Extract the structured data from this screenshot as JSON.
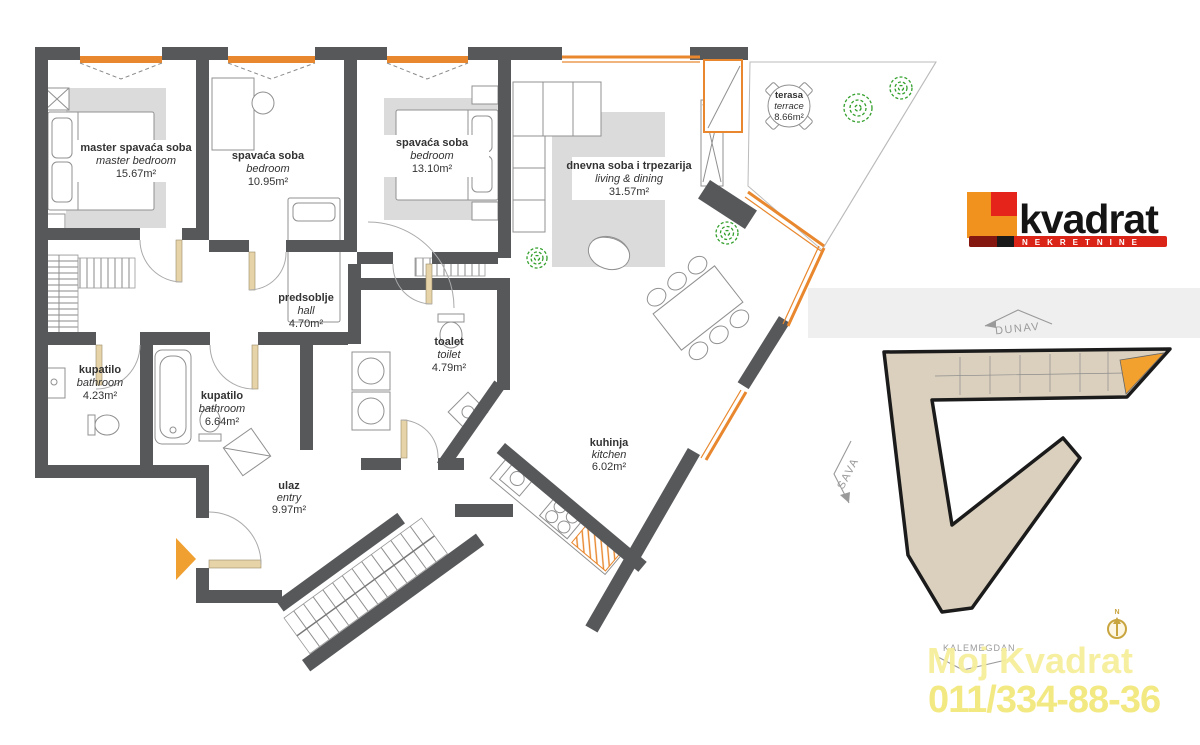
{
  "title": "Apartment floor plan",
  "floorplan": {
    "rooms": [
      {
        "id": "master-bedroom",
        "name_sr": "master spavaća soba",
        "name_en": "master bedroom",
        "area": "15.67m²"
      },
      {
        "id": "bedroom-2",
        "name_sr": "spavaća soba",
        "name_en": "bedroom",
        "area": "10.95m²"
      },
      {
        "id": "bedroom-3",
        "name_sr": "spavaća soba",
        "name_en": "bedroom",
        "area": "13.10m²"
      },
      {
        "id": "living-dining",
        "name_sr": "dnevna soba i trpezarija",
        "name_en": "living & dining",
        "area": "31.57m²"
      },
      {
        "id": "terrace",
        "name_sr": "terasa",
        "name_en": "terrace",
        "area": "8.66m²"
      },
      {
        "id": "hall",
        "name_sr": "predsoblje",
        "name_en": "hall",
        "area": "4.70m²"
      },
      {
        "id": "toilet",
        "name_sr": "toalet",
        "name_en": "toilet",
        "area": "4.79m²"
      },
      {
        "id": "bathroom-1",
        "name_sr": "kupatilo",
        "name_en": "bathroom",
        "area": "4.23m²"
      },
      {
        "id": "bathroom-2",
        "name_sr": "kupatilo",
        "name_en": "bathroom",
        "area": "6.64m²"
      },
      {
        "id": "entry",
        "name_sr": "ulaz",
        "name_en": "entry",
        "area": "9.97m²"
      },
      {
        "id": "kitchen",
        "name_sr": "kuhinja",
        "name_en": "kitchen",
        "area": "6.02m²"
      }
    ]
  },
  "siteplan": {
    "river_top": "DUNAV",
    "river_left": "SAVA",
    "landmark": "KALEMEGDAN",
    "north": "N"
  },
  "logo": {
    "name": "kvadrat",
    "tagline": "NEKRETNINE"
  },
  "watermark": {
    "line1": "Moj Kvadrat",
    "line2": "011/334-88-36"
  },
  "colors": {
    "wall": "#57585A",
    "window_orange": "#E8872D",
    "rug_gray": "#DBDBDB",
    "plant_green": "#33A02C",
    "building_fill": "#DBD0BE",
    "unit_highlight": "#F2A12F",
    "logo_orange": "#F2921E",
    "logo_red": "#DC2418",
    "watermark_yellow": "#F3E87C"
  }
}
